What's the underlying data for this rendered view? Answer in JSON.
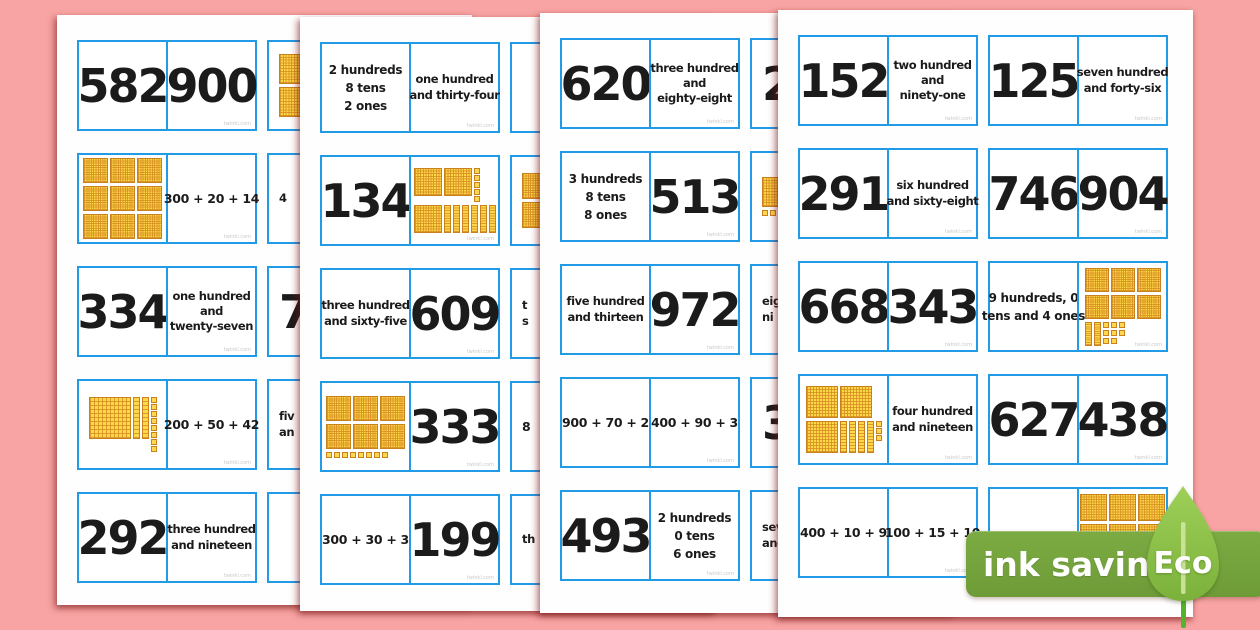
{
  "background_color": "#f8a4a4",
  "card_border_color": "#229be6",
  "block_colors": {
    "fill": "#FFD848",
    "grid": "#D69022",
    "border": "#C8811C"
  },
  "watermark": "twinkl.com",
  "badge": {
    "band_label": "ink saving",
    "leaf_label": "Eco",
    "band_color": "#74a53e",
    "leaf_color": "#8dc34b",
    "stem_color": "#55b22c"
  },
  "pages": [
    {
      "name": "page-1",
      "columns": [
        {
          "partial": false,
          "cards": [
            {
              "left": {
                "type": "number",
                "text": "582"
              },
              "right": {
                "type": "number",
                "text": "900"
              }
            },
            {
              "left": {
                "type": "blocks",
                "size": 25,
                "rows": [
                  [
                    "H",
                    "H",
                    "H"
                  ],
                  [
                    "H",
                    "H",
                    "H"
                  ],
                  [
                    "H",
                    "H",
                    "H"
                  ]
                ]
              },
              "right": {
                "type": "expanded",
                "text": "300 + 20 + 14"
              }
            },
            {
              "left": {
                "type": "number",
                "text": "334"
              },
              "right": {
                "type": "words",
                "lines": [
                  "one hundred",
                  "and",
                  "twenty-seven"
                ]
              }
            },
            {
              "left": {
                "type": "blocks",
                "size": 42,
                "rows": [
                  [
                    "H",
                    "T",
                    "T",
                    "O8col"
                  ]
                ]
              },
              "right": {
                "type": "expanded",
                "text": "200 + 50 + 42"
              }
            },
            {
              "left": {
                "type": "number",
                "text": "292"
              },
              "right": {
                "type": "words",
                "lines": [
                  "three hundred",
                  "and nineteen"
                ]
              }
            }
          ]
        },
        {
          "partial": true,
          "cards": [
            {
              "left": {
                "type": "blocks",
                "size": 30,
                "rows": [
                  [
                    "H"
                  ],
                  [
                    "H"
                  ]
                ],
                "frag": true
              }
            },
            {
              "left": {
                "type": "words",
                "lines": [
                  "4"
                ],
                "frag": true
              }
            },
            {
              "left": {
                "type": "number",
                "text": "7",
                "frag": true
              }
            },
            {
              "left": {
                "type": "words",
                "lines": [
                  "fiv",
                  "an"
                ],
                "frag": true
              }
            },
            {
              "left": {
                "type": "empty"
              }
            }
          ]
        }
      ]
    },
    {
      "name": "page-2",
      "columns": [
        {
          "partial": false,
          "cards": [
            {
              "left": {
                "type": "place-value",
                "lines": [
                  "2 hundreds",
                  "8 tens",
                  "2 ones"
                ]
              },
              "right": {
                "type": "words",
                "lines": [
                  "one hundred",
                  "and thirty-four"
                ]
              }
            },
            {
              "left": {
                "type": "number",
                "text": "134"
              },
              "right": {
                "type": "blocks",
                "size": 28,
                "rows": [
                  [
                    "H",
                    "H",
                    "O5col"
                  ],
                  [
                    "H",
                    "T",
                    "T",
                    "T",
                    "T",
                    "T",
                    "T"
                  ]
                ]
              }
            },
            {
              "left": {
                "type": "words",
                "lines": [
                  "three hundred",
                  "and sixty-five"
                ]
              },
              "right": {
                "type": "number",
                "text": "609"
              }
            },
            {
              "left": {
                "type": "blocks",
                "size": 25,
                "rows": [
                  [
                    "H",
                    "H",
                    "H"
                  ],
                  [
                    "H",
                    "H",
                    "H"
                  ],
                  [
                    "O8row"
                  ]
                ]
              },
              "right": {
                "type": "number",
                "text": "333"
              }
            },
            {
              "left": {
                "type": "expanded",
                "text": "300 + 30 + 3"
              },
              "right": {
                "type": "number",
                "text": "199"
              }
            }
          ]
        },
        {
          "partial": true,
          "cards": [
            {
              "left": {
                "type": "empty"
              }
            },
            {
              "left": {
                "type": "blocks",
                "size": 26,
                "rows": [
                  [
                    "H"
                  ],
                  [
                    "H"
                  ]
                ],
                "frag": true
              }
            },
            {
              "left": {
                "type": "words",
                "lines": [
                  "t",
                  "s"
                ],
                "frag": true
              }
            },
            {
              "left": {
                "type": "expanded",
                "text": "8",
                "frag": true
              }
            },
            {
              "left": {
                "type": "words",
                "lines": [
                  "th"
                ],
                "frag": true
              }
            }
          ]
        }
      ]
    },
    {
      "name": "page-3",
      "columns": [
        {
          "partial": false,
          "cards": [
            {
              "left": {
                "type": "number",
                "text": "620"
              },
              "right": {
                "type": "words",
                "lines": [
                  "three hundred",
                  "and",
                  "eighty-eight"
                ]
              }
            },
            {
              "left": {
                "type": "place-value",
                "lines": [
                  "3 hundreds",
                  "8 tens",
                  "8 ones"
                ]
              },
              "right": {
                "type": "number",
                "text": "513"
              }
            },
            {
              "left": {
                "type": "words",
                "lines": [
                  "five hundred",
                  "and thirteen"
                ]
              },
              "right": {
                "type": "number",
                "text": "972"
              }
            },
            {
              "left": {
                "type": "expanded",
                "text": "900 + 70 + 2"
              },
              "right": {
                "type": "expanded",
                "text": "400 + 90 + 3"
              }
            },
            {
              "left": {
                "type": "number",
                "text": "493"
              },
              "right": {
                "type": "place-value",
                "lines": [
                  "2 hundreds",
                  "0 tens",
                  "6 ones"
                ]
              }
            }
          ]
        },
        {
          "partial": true,
          "cards": [
            {
              "left": {
                "type": "number",
                "text": "2",
                "frag": true
              }
            },
            {
              "left": {
                "type": "blocks",
                "size": 30,
                "rows": [
                  [
                    "H"
                  ],
                  [
                    "O2row"
                  ]
                ],
                "frag": true
              }
            },
            {
              "left": {
                "type": "words",
                "lines": [
                  "eigh",
                  "ni"
                ],
                "frag": true
              }
            },
            {
              "left": {
                "type": "number",
                "text": "3",
                "frag": true
              }
            },
            {
              "left": {
                "type": "words",
                "lines": [
                  "sev",
                  "and"
                ],
                "frag": true
              }
            }
          ]
        }
      ]
    },
    {
      "name": "page-4",
      "columns": [
        {
          "partial": false,
          "cards": [
            {
              "left": {
                "type": "number",
                "text": "152"
              },
              "right": {
                "type": "words",
                "lines": [
                  "two hundred",
                  "and",
                  "ninety-one"
                ]
              }
            },
            {
              "left": {
                "type": "number",
                "text": "291"
              },
              "right": {
                "type": "words",
                "lines": [
                  "six hundred",
                  "and sixty-eight"
                ]
              }
            },
            {
              "left": {
                "type": "number",
                "text": "668"
              },
              "right": {
                "type": "number",
                "text": "343"
              }
            },
            {
              "left": {
                "type": "blocks",
                "size": 32,
                "rows": [
                  [
                    "H",
                    "H"
                  ],
                  [
                    "H",
                    "T",
                    "T",
                    "T",
                    "T",
                    "O3col"
                  ]
                ]
              },
              "right": {
                "type": "words",
                "lines": [
                  "four hundred",
                  "and nineteen"
                ]
              }
            },
            {
              "left": {
                "type": "expanded",
                "text": "400 + 10 + 9"
              },
              "right": {
                "type": "expanded",
                "text": "100 + 15 + 10"
              }
            }
          ]
        },
        {
          "partial": false,
          "cards": [
            {
              "left": {
                "type": "number",
                "text": "125"
              },
              "right": {
                "type": "words",
                "lines": [
                  "seven hundred",
                  "and forty-six"
                ]
              }
            },
            {
              "left": {
                "type": "number",
                "text": "746"
              },
              "right": {
                "type": "number",
                "text": "904"
              }
            },
            {
              "left": {
                "type": "place-value",
                "lines": [
                  "9 hundreds, 0",
                  "tens and 4 ones"
                ]
              },
              "right": {
                "type": "blocks",
                "size": 24,
                "rows": [
                  [
                    "H",
                    "H",
                    "H"
                  ],
                  [
                    "H",
                    "H",
                    "H"
                  ],
                  [
                    "T",
                    "T",
                    "O8grid3"
                  ]
                ]
              }
            },
            {
              "left": {
                "type": "number",
                "text": "627"
              },
              "right": {
                "type": "number",
                "text": "438"
              }
            },
            {
              "left": {
                "type": "empty"
              },
              "right": {
                "type": "blocks",
                "size": 27,
                "rows": [
                  [
                    "H",
                    "H",
                    "H"
                  ],
                  [
                    "H",
                    "H",
                    "H"
                  ]
                ],
                "align": "top"
              }
            }
          ]
        }
      ]
    }
  ]
}
